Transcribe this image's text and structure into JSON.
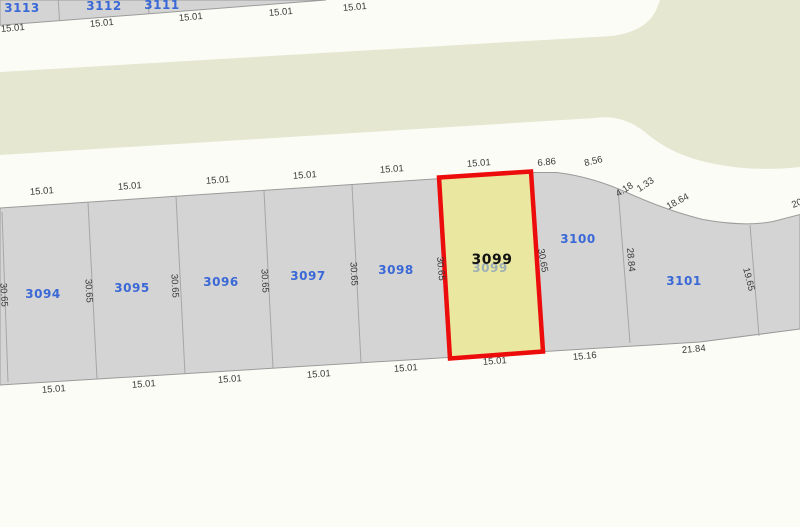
{
  "colors": {
    "background": "#fcfcf6",
    "open_space_green": "#e5e7d0",
    "parcel_gray": "#d4d4d4",
    "parcel_border": "#9b9b9b",
    "selection_red": "#ed0c0c",
    "selection_yellow_fill": "#eae7a0",
    "parcel_label_blue": "#3a68d6",
    "dimension_text": "#3a3a3a"
  },
  "top_strip": {
    "parcels": [
      {
        "id": "3113"
      },
      {
        "id": "3112"
      },
      {
        "id": "3111"
      }
    ],
    "frontage_dims": [
      "15.01",
      "15.01",
      "15.01",
      "15.01",
      "15.01"
    ]
  },
  "main_block": {
    "parcels": [
      {
        "id": "3094"
      },
      {
        "id": "3095"
      },
      {
        "id": "3096"
      },
      {
        "id": "3097"
      },
      {
        "id": "3098"
      },
      {
        "id": "3100"
      },
      {
        "id": "3101"
      }
    ],
    "selected_parcel": {
      "id": "3099",
      "underlying_id": "3099"
    },
    "front_dims": [
      "15.01",
      "15.01",
      "15.01",
      "15.01",
      "15.01",
      "15.01"
    ],
    "upper_right_dims": [
      "6.86",
      "8.56",
      "4.18",
      "1.33",
      "18.64",
      "20"
    ],
    "depth_dims": [
      "30.65",
      "30.65",
      "30.65",
      "30.65",
      "30.65",
      "30.65",
      "30.65",
      "28.84",
      "19.65"
    ],
    "rear_dims": [
      "15.01",
      "15.01",
      "15.01",
      "15.01",
      "15.01",
      "15.01",
      "15.16",
      "21.84"
    ]
  }
}
